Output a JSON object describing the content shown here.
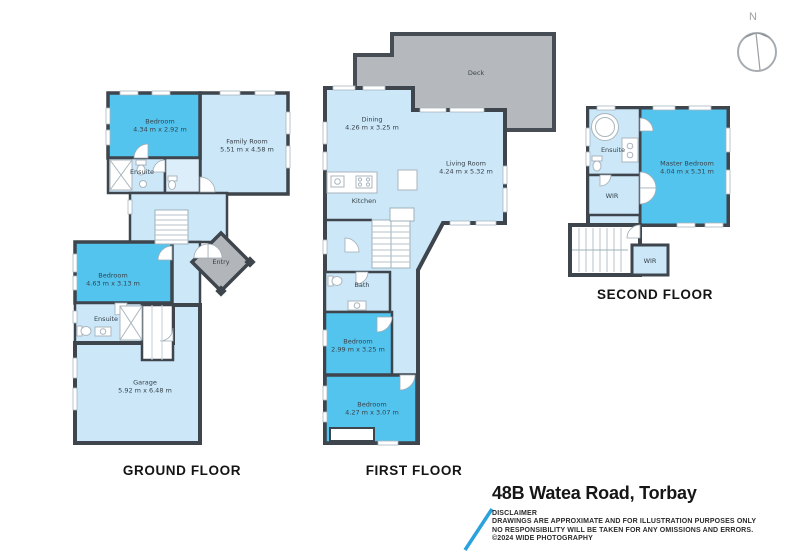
{
  "compass": {
    "label": "N"
  },
  "floors": [
    {
      "label": "GROUND FLOOR",
      "rooms": [
        {
          "name": "Bedroom",
          "dims": "4.34 m x 2.92 m"
        },
        {
          "name": "Family Room",
          "dims": "5.51 m x 4.58 m"
        },
        {
          "name": "Ensuite",
          "dims": ""
        },
        {
          "name": "Entry",
          "dims": ""
        },
        {
          "name": "Bedroom",
          "dims": "4.63 m x 3.13 m"
        },
        {
          "name": "Ensuite",
          "dims": ""
        },
        {
          "name": "Garage",
          "dims": "5.92 m x 6.48 m"
        }
      ]
    },
    {
      "label": "FIRST FLOOR",
      "rooms": [
        {
          "name": "Deck",
          "dims": ""
        },
        {
          "name": "Dining",
          "dims": "4.26 m x 3.25 m"
        },
        {
          "name": "Living Room",
          "dims": "4.24 m x 5.32 m"
        },
        {
          "name": "Kitchen",
          "dims": ""
        },
        {
          "name": "Bath",
          "dims": ""
        },
        {
          "name": "Bedroom",
          "dims": "2.99 m x 3.25 m"
        },
        {
          "name": "Bedroom",
          "dims": "4.27 m x 3.07 m"
        }
      ]
    },
    {
      "label": "SECOND FLOOR",
      "rooms": [
        {
          "name": "Ensuite",
          "dims": ""
        },
        {
          "name": "WIR",
          "dims": ""
        },
        {
          "name": "Master Bedroom",
          "dims": "4.04 m x 5.31 m"
        },
        {
          "name": "WIR",
          "dims": ""
        }
      ]
    }
  ],
  "footer": {
    "address": "48B Watea Road, Torbay",
    "disclaimer_title": "DISCLAIMER",
    "disclaimer_lines": [
      "DRAWINGS ARE APPROXIMATE AND FOR ILLUSTRATION PURPOSES ONLY",
      "NO RESPONSIBILITY WILL BE TAKEN FOR ANY OMISSIONS AND ERRORS.",
      "©2024 WIDE PHOTOGRAPHY"
    ]
  },
  "colors": {
    "wall": "#3e454c",
    "room_light": "#cbe7f8",
    "room_dark": "#53c4ee",
    "deck_gray": "#b5b9bd",
    "accent_blue": "#2aa2dd"
  }
}
